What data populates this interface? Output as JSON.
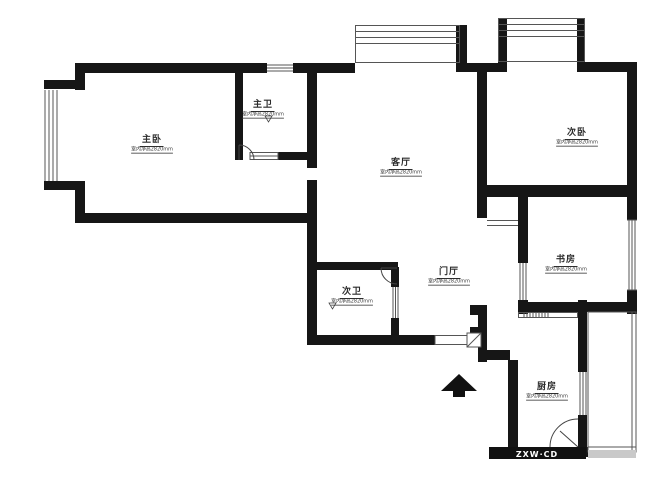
{
  "floorplan": {
    "rooms": [
      {
        "id": "master-bedroom",
        "name": "主卧",
        "dim": "室内净高2820mm"
      },
      {
        "id": "master-bath",
        "name": "主卫",
        "dim": "室内净高2820mm"
      },
      {
        "id": "living-room",
        "name": "客厅",
        "dim": "室内净高2820mm"
      },
      {
        "id": "second-bedroom",
        "name": "次卧",
        "dim": "室内净高2820mm"
      },
      {
        "id": "study",
        "name": "书房",
        "dim": "室内净高2820mm"
      },
      {
        "id": "foyer",
        "name": "门厅",
        "dim": "室内净高2820mm"
      },
      {
        "id": "second-bath",
        "name": "次卫",
        "dim": "室内净高2820mm"
      },
      {
        "id": "kitchen",
        "name": "厨房",
        "dim": "室内净高2820mm"
      }
    ],
    "watermark": "ZXW·CD",
    "colors": {
      "wall": "#161616",
      "thin_line": "#555555",
      "bg": "#ffffff"
    }
  }
}
